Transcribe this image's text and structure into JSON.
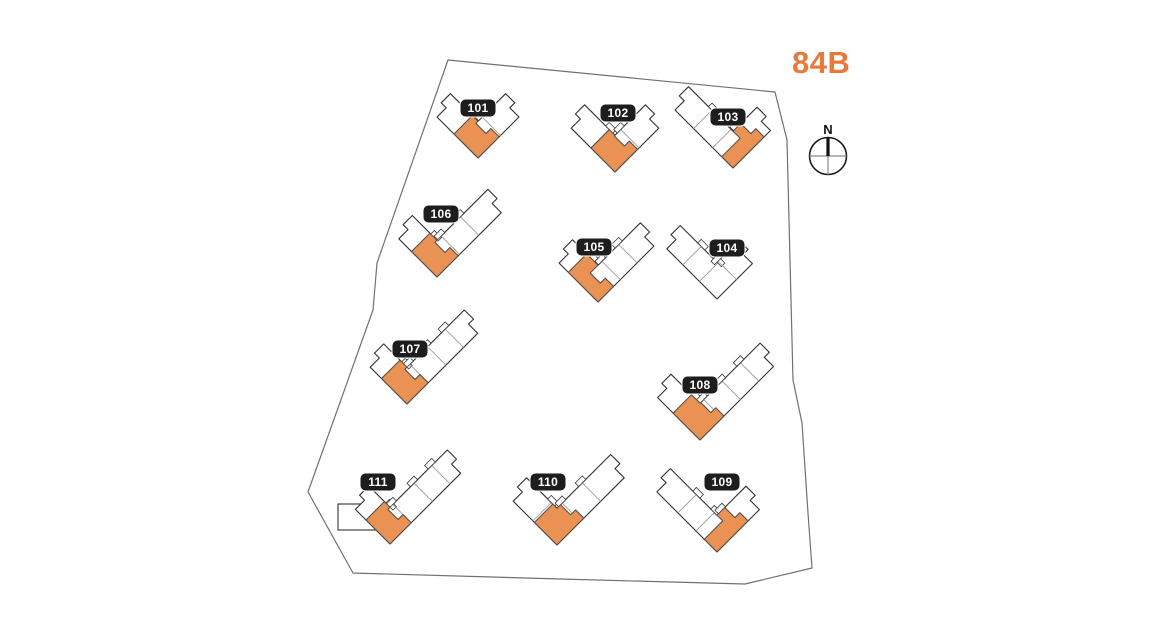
{
  "title": {
    "text": "84B",
    "color": "#E8793B"
  },
  "compass": {
    "label": "N"
  },
  "style": {
    "background": "#ffffff",
    "boundary_stroke": "#707070",
    "building_fill": "#ffffff",
    "building_stroke": "#333333",
    "divider_stroke": "#9b9b9b",
    "unit_fill": "#EA9254",
    "unit_stroke": "#4a4a4a",
    "badge_bg": "#1d1d1d",
    "badge_text_color": "#ffffff"
  },
  "boundary": {
    "points": [
      [
        448,
        60
      ],
      [
        775,
        92
      ],
      [
        787,
        140
      ],
      [
        793,
        380
      ],
      [
        802,
        423
      ],
      [
        808,
        513
      ],
      [
        812,
        568
      ],
      [
        745,
        584
      ],
      [
        560,
        579
      ],
      [
        353,
        573
      ],
      [
        308,
        492
      ],
      [
        373,
        310
      ],
      [
        377,
        263
      ]
    ]
  },
  "buildings": [
    {
      "label": "101",
      "tip": [
        478,
        158
      ],
      "leftLen": 58,
      "rightLen": 58,
      "width": 26,
      "badge": [
        478,
        108
      ],
      "unit": {
        "a": 34,
        "b": 30
      },
      "leftDividers": [
        0.55
      ],
      "rightDividers": [
        0.55
      ]
    },
    {
      "label": "102",
      "tip": [
        615,
        172
      ],
      "leftLen": 62,
      "rightLen": 62,
      "width": 26,
      "badge": [
        618,
        113
      ],
      "unit": {
        "a": 34,
        "b": 32
      },
      "leftDividers": [
        0.55
      ],
      "rightDividers": [
        0.55
      ]
    },
    {
      "label": "103",
      "tip": [
        733,
        168
      ],
      "leftLen": 82,
      "rightLen": 53,
      "width": 26,
      "badge": [
        728,
        117
      ],
      "unit": {
        "a": 16,
        "b": 44
      },
      "leftDividers": [
        0.35,
        0.68
      ],
      "rightDividers": [
        0.6
      ]
    },
    {
      "label": "104",
      "tip": [
        717,
        299
      ],
      "leftLen": 71,
      "rightLen": 50,
      "width": 26,
      "badge": [
        727,
        248
      ],
      "unit": null,
      "leftDividers": [
        0.35,
        0.68
      ],
      "rightDividers": [
        0.55
      ]
    },
    {
      "label": "105",
      "tip": [
        598,
        302
      ],
      "leftLen": 55,
      "rightLen": 79,
      "width": 26,
      "badge": [
        594,
        247
      ],
      "unit": {
        "a": 42,
        "b": 22
      },
      "leftDividers": [
        0.6
      ],
      "rightDividers": [
        0.4,
        0.7
      ]
    },
    {
      "label": "106",
      "tip": [
        437,
        277
      ],
      "leftLen": 54,
      "rightLen": 91,
      "width": 26,
      "badge": [
        441,
        214
      ],
      "unit": {
        "a": 36,
        "b": 30
      },
      "leftDividers": [
        0.55
      ],
      "rightDividers": [
        0.35,
        0.65
      ]
    },
    {
      "label": "107",
      "tip": [
        407,
        404
      ],
      "leftLen": 52,
      "rightLen": 100,
      "width": 26,
      "badge": [
        410,
        349
      ],
      "unit": {
        "a": 36,
        "b": 30
      },
      "leftDividers": [
        0.55
      ],
      "rightDividers": [
        0.3,
        0.55,
        0.8
      ]
    },
    {
      "label": "108",
      "tip": [
        700,
        440
      ],
      "leftLen": 60,
      "rightLen": 104,
      "width": 26,
      "badge": [
        700,
        385
      ],
      "unit": {
        "a": 38,
        "b": 34
      },
      "leftDividers": [
        0.55
      ],
      "rightDividers": [
        0.3,
        0.55,
        0.8
      ]
    },
    {
      "label": "109",
      "tip": [
        717,
        552
      ],
      "leftLen": 85,
      "rightLen": 60,
      "width": 26,
      "badge": [
        722,
        482
      ],
      "unit": {
        "a": 18,
        "b": 44
      },
      "leftDividers": [
        0.35,
        0.65
      ],
      "rightDividers": [
        0.55
      ]
    },
    {
      "label": "110",
      "tip": [
        557,
        545
      ],
      "leftLen": 62,
      "rightLen": 95,
      "width": 26,
      "badge": [
        548,
        482
      ],
      "unit": {
        "a": 32,
        "b": 38
      },
      "leftDividers": [
        0.55
      ],
      "rightDividers": [
        0.35,
        0.65
      ]
    },
    {
      "label": "111",
      "tip": [
        390,
        544
      ],
      "leftLen": 49,
      "rightLen": 100,
      "width": 26,
      "badge": [
        378,
        482
      ],
      "unit": {
        "a": 34,
        "b": 30
      },
      "annex": [
        338,
        504,
        38,
        26
      ],
      "leftDividers": [
        0.55
      ],
      "rightDividers": [
        0.3,
        0.6,
        0.85
      ]
    }
  ]
}
